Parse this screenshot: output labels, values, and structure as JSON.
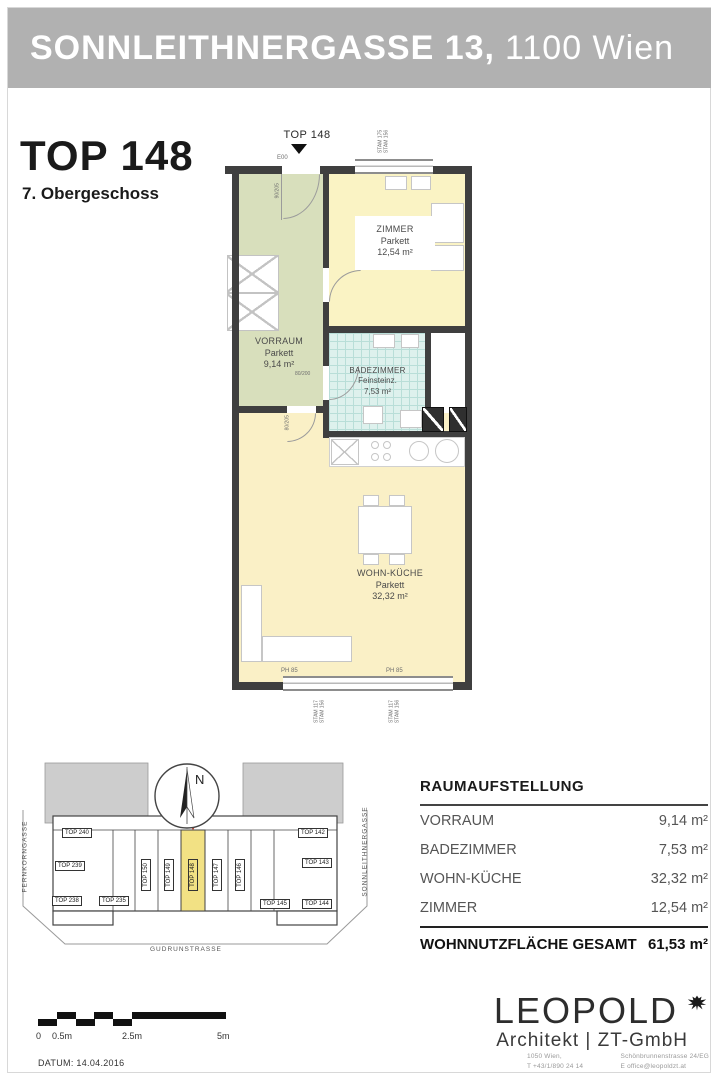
{
  "header": {
    "address_bold": "SONNLEITHNERGASSE 13,",
    "address_light": "1100 Wien"
  },
  "title": {
    "unit": "TOP 148",
    "floor": "7. Obergeschoss"
  },
  "plan": {
    "pointer_label": "TOP 148",
    "entrance_label": "E00",
    "entrance_door_size": "90/205",
    "bath_door_size": "80/200",
    "living_door_size": "80/205",
    "labels": {
      "ph": "PH 85",
      "stam_top_1": "STAM 175",
      "stam_top_2": "STAM 156",
      "stam_bottom_1": "STAM 117",
      "stam_bottom_2": "STAM 156"
    },
    "rooms": {
      "vorraum": {
        "name": "VORRAUM",
        "finish": "Parkett",
        "area": "9,14 m²"
      },
      "zimmer": {
        "name": "ZIMMER",
        "finish": "Parkett",
        "area": "12,54 m²"
      },
      "badezimmer": {
        "name": "BADEZIMMER",
        "finish": "Feinsteinz.",
        "area": "7,53 m²"
      },
      "wohnkueche": {
        "name": "WOHN-KÜCHE",
        "finish": "Parkett",
        "area": "32,32 m²"
      }
    },
    "colors": {
      "wall": "#3f3f3f",
      "vorraum": "#d8dfbc",
      "zimmer": "#faf3c4",
      "bad": "#def1ed",
      "wohn": "#faf0c6"
    }
  },
  "siteplan": {
    "compass": "N",
    "streets": {
      "left": "FERNKORNGASSE",
      "right": "SONNLEITHNERGASSE",
      "bottom": "GUDRUNSTRASSE"
    },
    "highlight_color": "#f2e184",
    "units": [
      {
        "label": "TOP 240"
      },
      {
        "label": "TOP 239"
      },
      {
        "label": "TOP 238"
      },
      {
        "label": "TOP 235"
      },
      {
        "label": "TOP 150"
      },
      {
        "label": "TOP 149"
      },
      {
        "label": "TOP 148",
        "highlighted": true
      },
      {
        "label": "TOP 147"
      },
      {
        "label": "TOP 146"
      },
      {
        "label": "TOP 142"
      },
      {
        "label": "TOP 143"
      },
      {
        "label": "TOP 145"
      },
      {
        "label": "TOP 144"
      }
    ]
  },
  "table": {
    "title": "RAUMAUFSTELLUNG",
    "rows": [
      {
        "name": "VORRAUM",
        "area": "9,14 m²"
      },
      {
        "name": "BADEZIMMER",
        "area": "7,53 m²"
      },
      {
        "name": "WOHN-KÜCHE",
        "area": "32,32 m²"
      },
      {
        "name": "ZIMMER",
        "area": "12,54 m²"
      }
    ],
    "total": {
      "name": "WOHNNUTZFLÄCHE GESAMT",
      "area": "61,53 m²"
    }
  },
  "footer": {
    "brand": "LEOPOLD",
    "brand_sub": "Architekt | ZT-GmbH",
    "address_city": "1050  Wien,",
    "phone": "T   +43/1/890 24 14",
    "address_street": "Schönbrunnenstrasse 24/EG",
    "email": "E   office@leopoldzt.at"
  },
  "scalebar": {
    "labels": [
      "0",
      "0.5m",
      "2.5m",
      "5m"
    ],
    "datum": "DATUM: 14.04.2016"
  }
}
